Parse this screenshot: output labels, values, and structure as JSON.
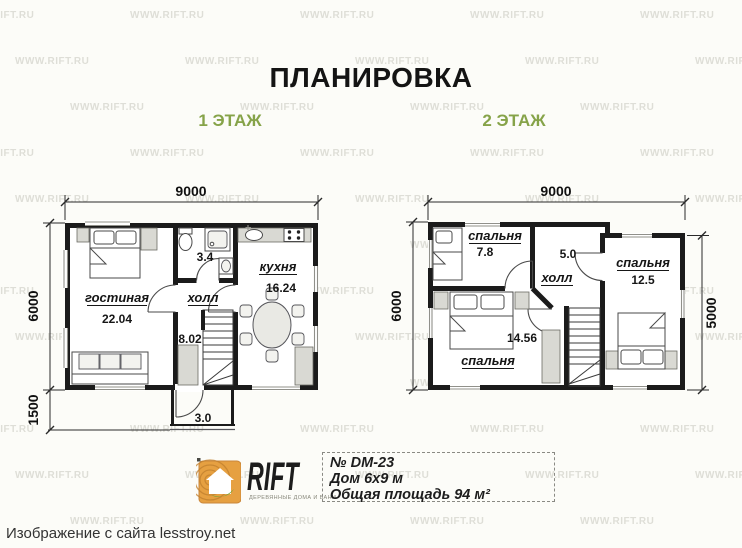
{
  "header": {
    "title": "ПЛАНИРОВКА"
  },
  "watermark": {
    "text": "WWW.RIFT.RU"
  },
  "floor1": {
    "label": "1 ЭТАЖ",
    "dim_width": "9000",
    "dim_height": "6000",
    "dim_porch": "1500",
    "rooms": {
      "living": {
        "name": "гостиная",
        "area": "22.04"
      },
      "hall": {
        "name": "холл",
        "area": "8.02"
      },
      "kitchen": {
        "name": "кухня",
        "area": "16.24"
      },
      "bath": {
        "area": "3.4"
      },
      "porch": {
        "area": "3.0"
      }
    }
  },
  "floor2": {
    "label": "2 ЭТАЖ",
    "dim_width": "9000",
    "dim_height": "6000",
    "dim_right": "5000",
    "rooms": {
      "bedroom_small": {
        "name": "спальня",
        "area": "7.8"
      },
      "hall": {
        "name": "холл",
        "area": "5.0"
      },
      "bedroom_right": {
        "name": "спальня",
        "area": "12.5"
      },
      "bedroom_large": {
        "name": "спальня",
        "area": "14.56"
      }
    }
  },
  "logo": {
    "brand": "RIFT",
    "tagline": "ДЕРЕВЯННЫЕ ДОМА И БАНИ"
  },
  "info_box": {
    "line1": "№ DM-23",
    "line2": "Дом 6х9 м",
    "line3": "Общая площадь 94 м²"
  },
  "footer": {
    "caption": "Изображение с сайта lesstroy.net"
  },
  "colors": {
    "accent_green": "#86a349",
    "wall": "#1b1b1b",
    "logo_orange": "#e6a041"
  }
}
